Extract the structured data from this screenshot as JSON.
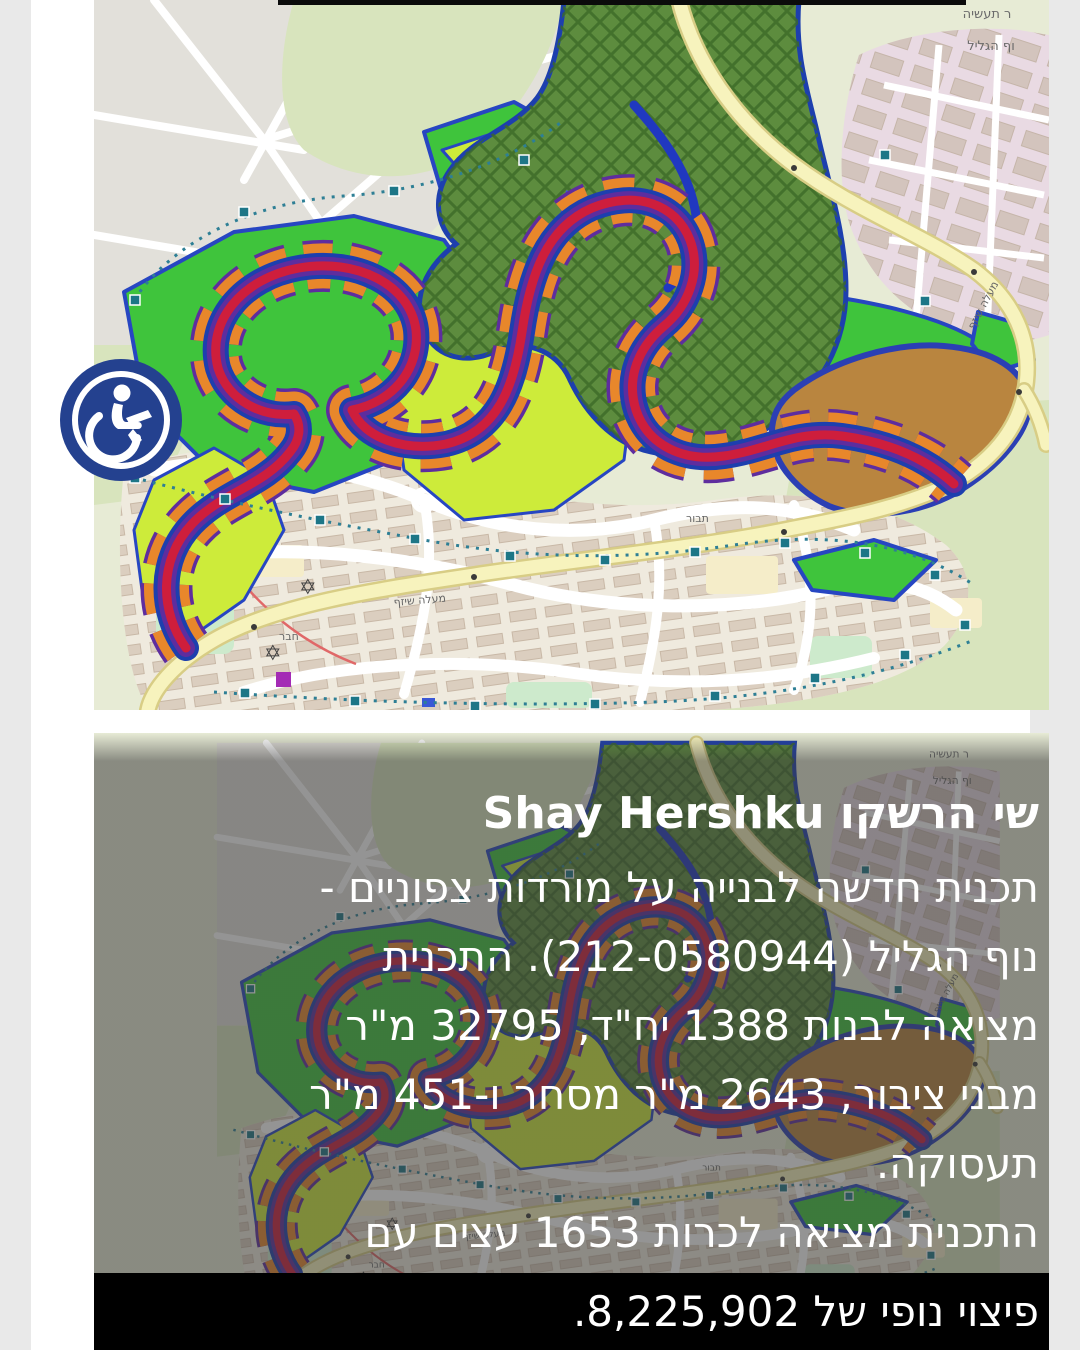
{
  "page": {
    "side_bg": "#e9e9e9",
    "card_bg": "#ffffff",
    "footer_bg": "#000000",
    "text_color": "#ffffff"
  },
  "post": {
    "author": "שי הרשקו Shay Hershku",
    "body_lines": [
      "תכנית חדשה לבנייה על מורדות צפוניים -",
      "נוף הגליל (212-0580944). התכנית",
      "מציאה לבנות 1388 יח\"ד, 32795 מ\"ר",
      "מבני ציבור, 2643 מ\"ר מסחר ו-451 מ\"ר",
      "תעסוקה.",
      "התכנית מציאה לכרות 1653 עצים עם"
    ],
    "footer_line": "פיצוי נופי של 8,225,902."
  },
  "badge": {
    "icon": "wheelchair-accessibility",
    "color": "#24418f"
  },
  "map": {
    "labels": {
      "industrial_top": "ר תעשיה",
      "nof_hagalil_top": "וף הגליל",
      "maale_shizaf_upper": "מעלה שיזף",
      "maale_shizaf_lower": "מעלה שיזף",
      "street_haver": "חבר",
      "street_tavor": "תבור"
    },
    "colors": {
      "background": "#e7ebd5",
      "woods": "#d8e4bd",
      "urban_gray": "#e2e0da",
      "city_base": "#efeade",
      "pink_urban": "#e9dae3",
      "forest_green": "#5d8c3e",
      "forest_hatch": "#3c6a27",
      "plan_green": "#3fc43c",
      "plan_chartreuse": "#cdeb3a",
      "plan_orange": "#e8872b",
      "plan_red": "#ce1e3c",
      "plan_purple": "#5e2d9e",
      "plan_blue": "#1d3fae",
      "brown_lot": "#b9853f",
      "yellow_road": "#f7f3bd",
      "teal_marker": "#1d7687"
    }
  }
}
